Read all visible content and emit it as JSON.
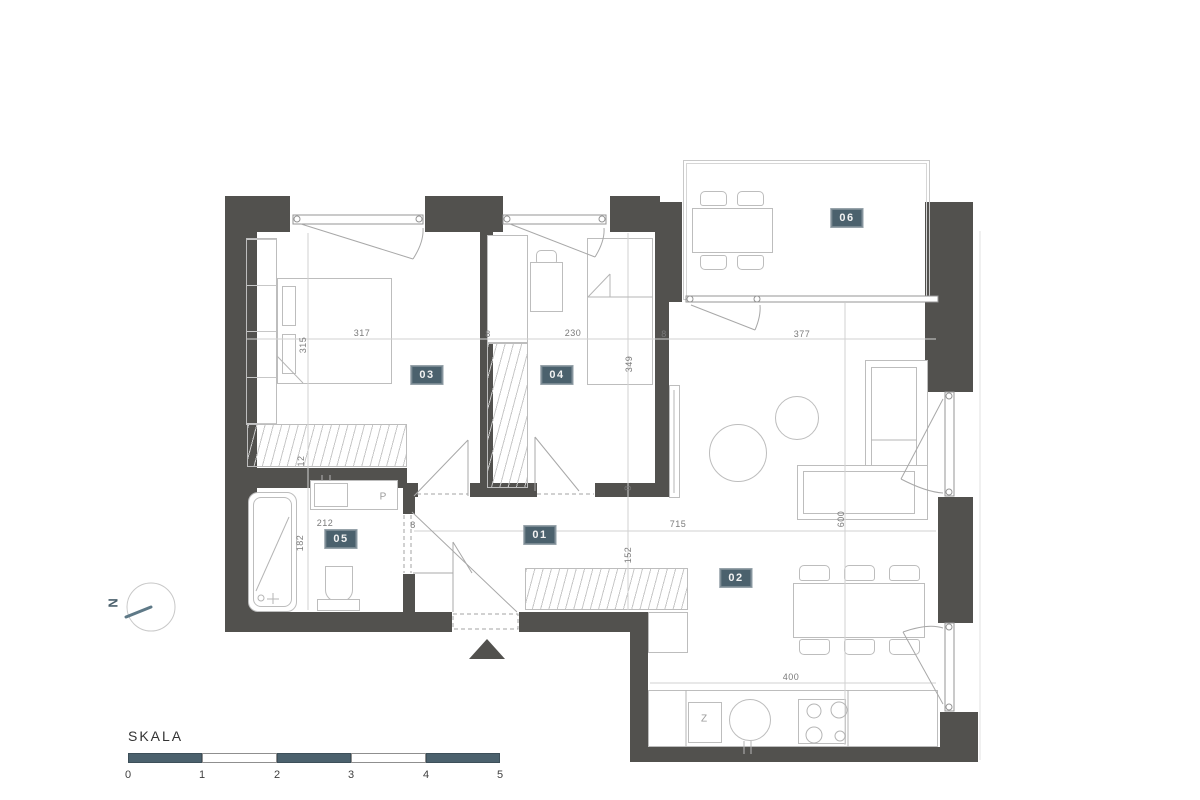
{
  "colors": {
    "wall": "#52514e",
    "accent": "#4b616d",
    "furniture_line": "#bdbdbd",
    "dim_text": "#7a7a7a"
  },
  "rooms": [
    {
      "id": "01"
    },
    {
      "id": "02"
    },
    {
      "id": "03"
    },
    {
      "id": "04"
    },
    {
      "id": "05"
    },
    {
      "id": "06"
    }
  ],
  "dimensions": [
    {
      "text": "317"
    },
    {
      "text": "315"
    },
    {
      "text": "8"
    },
    {
      "text": "230"
    },
    {
      "text": "8"
    },
    {
      "text": "377"
    },
    {
      "text": "349"
    },
    {
      "text": "12"
    },
    {
      "text": "8"
    },
    {
      "text": "212"
    },
    {
      "text": "8"
    },
    {
      "text": "715"
    },
    {
      "text": "152"
    },
    {
      "text": "182"
    },
    {
      "text": "600"
    },
    {
      "text": "400"
    }
  ],
  "fixtures": {
    "washing_machine": "P",
    "kitchen_appliance": "Z"
  },
  "compass": {
    "label": "N"
  },
  "scale": {
    "title": "SKALA",
    "ticks": [
      "0",
      "1",
      "2",
      "3",
      "4",
      "5"
    ]
  }
}
